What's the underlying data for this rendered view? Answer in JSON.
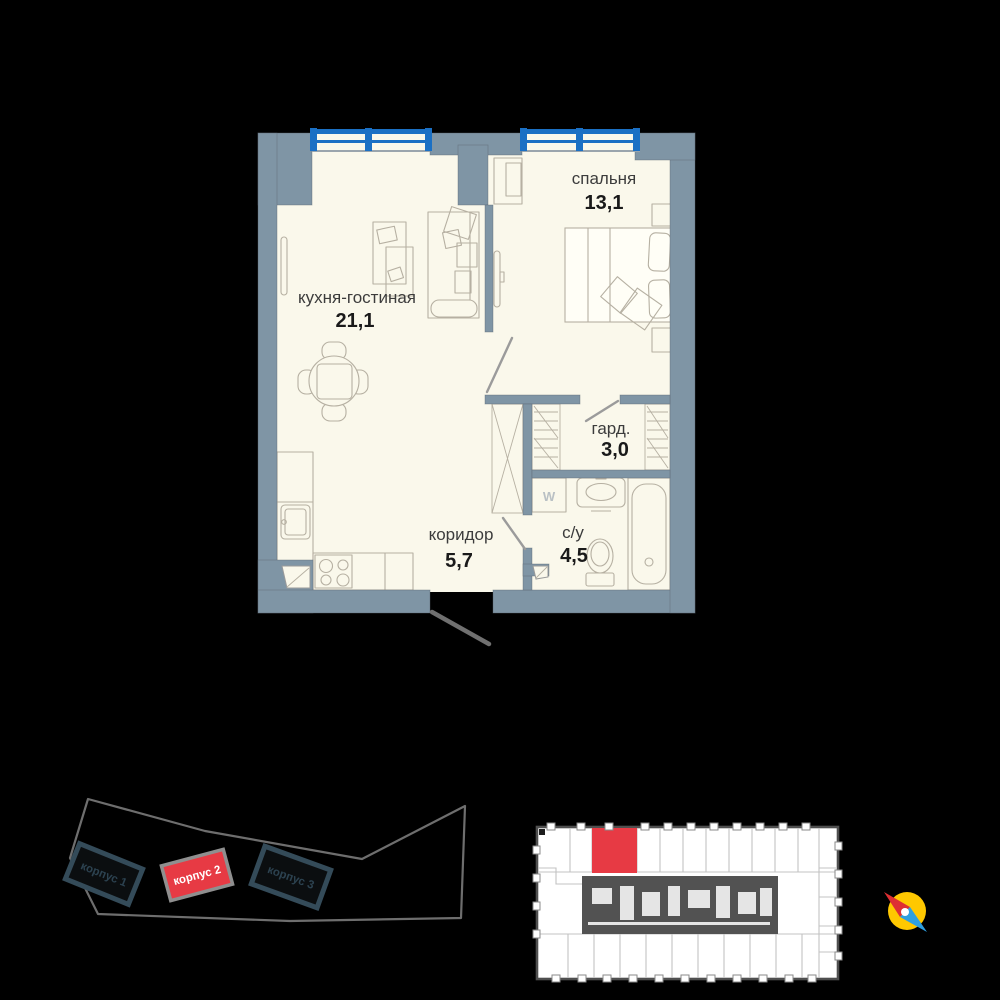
{
  "floor_plan": {
    "rooms": [
      {
        "name": "кухня-гостиная",
        "area": "21,1"
      },
      {
        "name": "спальня",
        "area": "13,1"
      },
      {
        "name": "гард.",
        "area": "3,0"
      },
      {
        "name": "коридор",
        "area": "5,7"
      },
      {
        "name": "с/у",
        "area": "4,5"
      }
    ],
    "washer_label": "W"
  },
  "site_plan": {
    "buildings": [
      {
        "label": "корпус 1",
        "highlighted": false
      },
      {
        "label": "корпус 2",
        "highlighted": true
      },
      {
        "label": "корпус 3",
        "highlighted": false
      }
    ]
  },
  "colors": {
    "background": "#000000",
    "floor": "#FAF8EB",
    "wall": "#7F95A5",
    "wall-edge": "#5A646D",
    "window-blue": "#1B70C4",
    "furniture": "#B6B0A2",
    "label": "#3C3C3C",
    "area": "#1A1A1A",
    "accent-red": "#E73A44",
    "site-line": "#6E6E6E",
    "building-dark": "#344B59",
    "key-border": "#4F4F4F",
    "key-line": "#C3C3C3",
    "key-core": "#525252",
    "compass-yellow": "#FFC800",
    "compass-red": "#DE2F33",
    "compass-blue": "#2E9FE0",
    "door": "#9B9B9B",
    "entry-door": "#707070",
    "washer": "#B9C0C4",
    "bed-fill": "#FFFEF6"
  }
}
